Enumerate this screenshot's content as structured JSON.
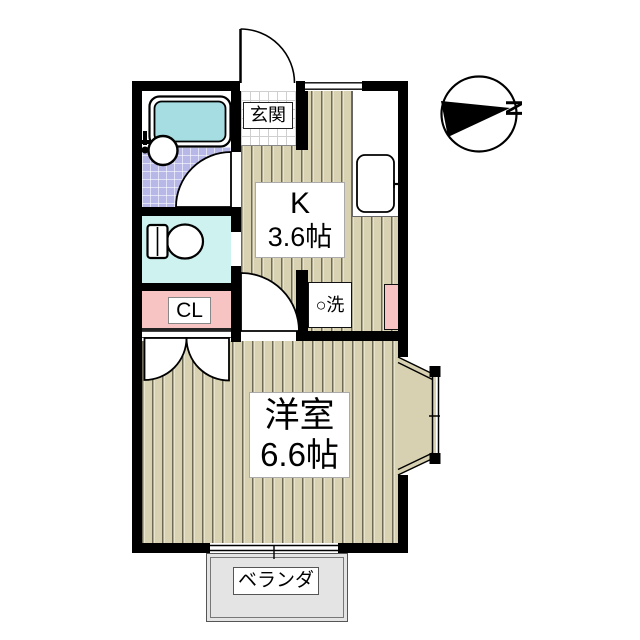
{
  "plan": {
    "entrance_label": "玄関",
    "kitchen_label_1": "K",
    "kitchen_label_2": "3.6帖",
    "closet_label": "CL",
    "washer_label": "○洗",
    "room_label_1": "洋室",
    "room_label_2": "6.6帖",
    "veranda_label": "ベランダ",
    "compass_label": "N"
  },
  "colors": {
    "wall": "#000000",
    "wood_floor": "#d8d2b2",
    "wood_floor_line": "#6e6a56",
    "bath_tile": "#b7b7e8",
    "bathtub": "#a5dde3",
    "toilet_floor": "#cdf2f0",
    "closet_pink": "#f7c3c3",
    "veranda_gray": "#e4e4e4"
  }
}
